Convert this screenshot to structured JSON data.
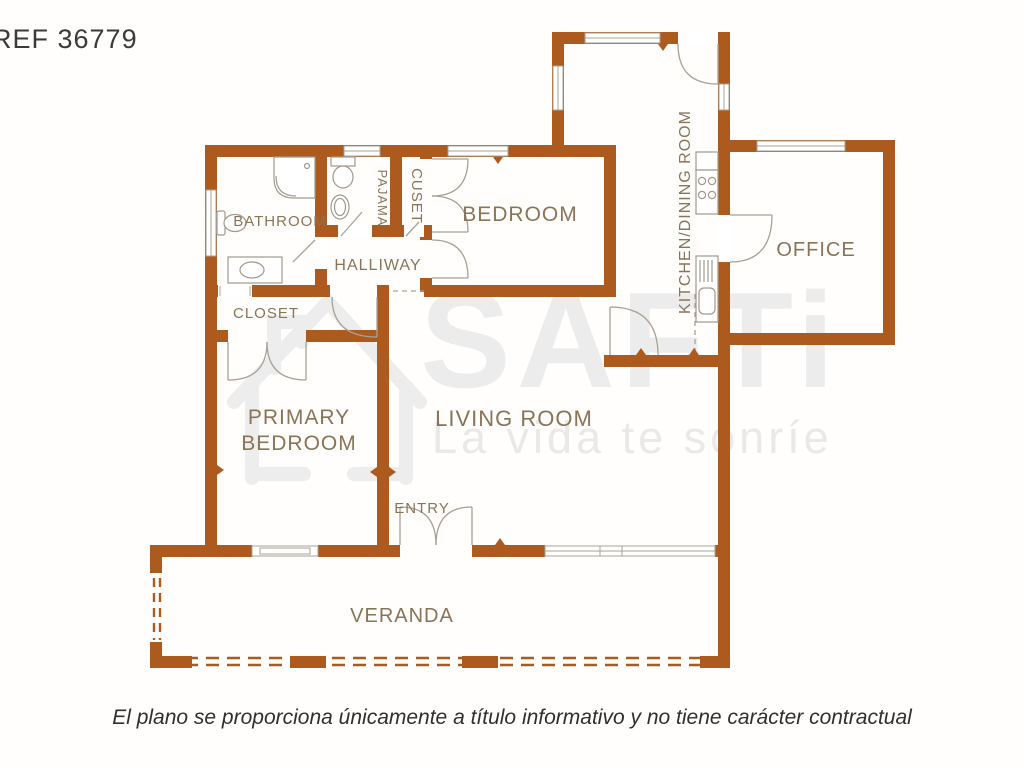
{
  "header": {
    "ref": "REF 36779"
  },
  "watermark": {
    "brand": "SAFTi",
    "slogan": "La vida te sonríe"
  },
  "rooms": {
    "bathroom": "BATHROOM",
    "pajama": "PAJAMA",
    "closet_small": "CUSET",
    "bedroom": "BEDROOM",
    "kitchen_dining": "KITCHEN/DINING ROOM",
    "office": "OFFICE",
    "hallway": "HALLIWAY",
    "closet": "CLOSET",
    "primary_line1": "PRIMARY",
    "primary_line2": "BEDROOM",
    "living": "LIVING ROOM",
    "entry": "ENTRY",
    "veranda": "VERANDA"
  },
  "footer": {
    "disclaimer": "El plano se proporciona únicamente a título informativo y no tiene carácter contractual"
  },
  "colors": {
    "wall": "#AD5A1E",
    "room_label": "#8A7457",
    "fixture_line": "#A8A296",
    "watermark_gray": "#ECECEC",
    "ref_text": "#3B3B3B",
    "disclaimer_text": "#2F2F2F"
  }
}
